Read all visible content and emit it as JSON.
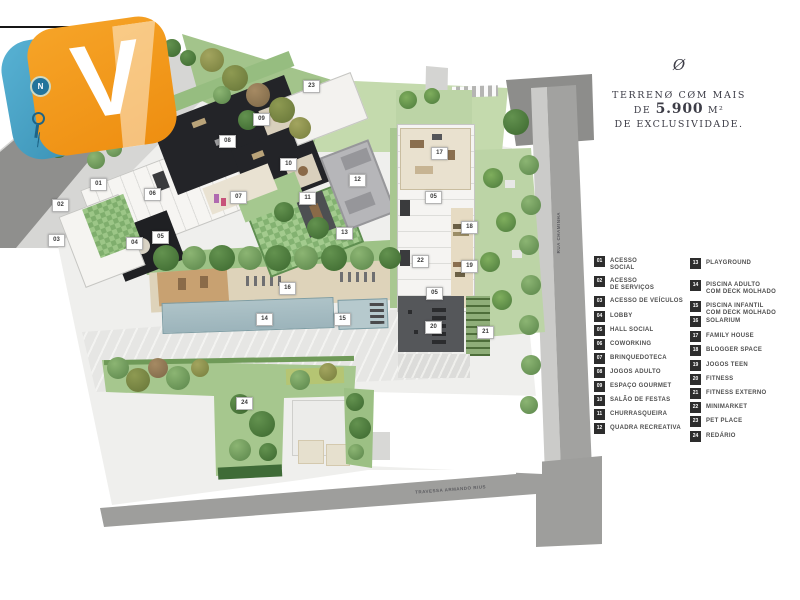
{
  "watermark": {
    "letter": "V",
    "compass": "N"
  },
  "headline": {
    "ornament": "Ø",
    "line1": "TERRENØ CØM MAIS",
    "line2_de": "DE",
    "line2_value": "5.900",
    "line2_unit": "M²",
    "line3": "DE EXCLUSIVIDADE."
  },
  "streets": {
    "bottom": "TRAVESSA ARMANDO RIUS",
    "right": "RUA CHAMINHA"
  },
  "legend": {
    "items": [
      {
        "num": "01",
        "l1": "ACESSO",
        "l2": "SOCIAL"
      },
      {
        "num": "02",
        "l1": "ACESSO",
        "l2": "DE SERVIÇOS"
      },
      {
        "num": "03",
        "l1": "ACESSO DE VEÍCULOS",
        "l2": ""
      },
      {
        "num": "04",
        "l1": "LOBBY",
        "l2": ""
      },
      {
        "num": "05",
        "l1": "HALL SOCIAL",
        "l2": ""
      },
      {
        "num": "06",
        "l1": "COWORKING",
        "l2": ""
      },
      {
        "num": "07",
        "l1": "BRINQUEDOTECA",
        "l2": ""
      },
      {
        "num": "08",
        "l1": "JOGOS ADULTO",
        "l2": ""
      },
      {
        "num": "09",
        "l1": "ESPAÇO GOURMET",
        "l2": ""
      },
      {
        "num": "10",
        "l1": "SALÃO DE FESTAS",
        "l2": ""
      },
      {
        "num": "11",
        "l1": "CHURRASQUEIRA",
        "l2": ""
      },
      {
        "num": "12",
        "l1": "QUADRA RECREATIVA",
        "l2": ""
      },
      {
        "num": "13",
        "l1": "PLAYGROUND",
        "l2": ""
      },
      {
        "num": "14",
        "l1": "PISCINA ADULTO",
        "l2": "COM DECK MOLHADO"
      },
      {
        "num": "15",
        "l1": "PISCINA INFANTIL",
        "l2": "COM DECK MOLHADO"
      },
      {
        "num": "16",
        "l1": "SOLARIUM",
        "l2": ""
      },
      {
        "num": "17",
        "l1": "FAMILY HOUSE",
        "l2": ""
      },
      {
        "num": "18",
        "l1": "BLOGGER SPACE",
        "l2": ""
      },
      {
        "num": "19",
        "l1": "JOGOS TEEN",
        "l2": ""
      },
      {
        "num": "20",
        "l1": "FITNESS",
        "l2": ""
      },
      {
        "num": "21",
        "l1": "FITNESS EXTERNO",
        "l2": ""
      },
      {
        "num": "22",
        "l1": "MINIMARKET",
        "l2": ""
      },
      {
        "num": "23",
        "l1": "PET PLACE",
        "l2": ""
      },
      {
        "num": "24",
        "l1": "REDÁRIO",
        "l2": ""
      }
    ]
  },
  "map": {
    "markers": [
      "01",
      "02",
      "03",
      "04",
      "05",
      "06",
      "07",
      "08",
      "09",
      "10",
      "11",
      "12",
      "13",
      "14",
      "15",
      "16",
      "17",
      "05",
      "18",
      "19",
      "22",
      "05",
      "20",
      "21",
      "23",
      "24"
    ]
  },
  "colors": {
    "brand_orange": "#f49a1c",
    "brand_blue": "#3b97bd",
    "legend_square": "#2d2d2d",
    "headline_text": "#3d3d47",
    "pool_water": "#a7bdc3",
    "building_dark": "#232428"
  }
}
